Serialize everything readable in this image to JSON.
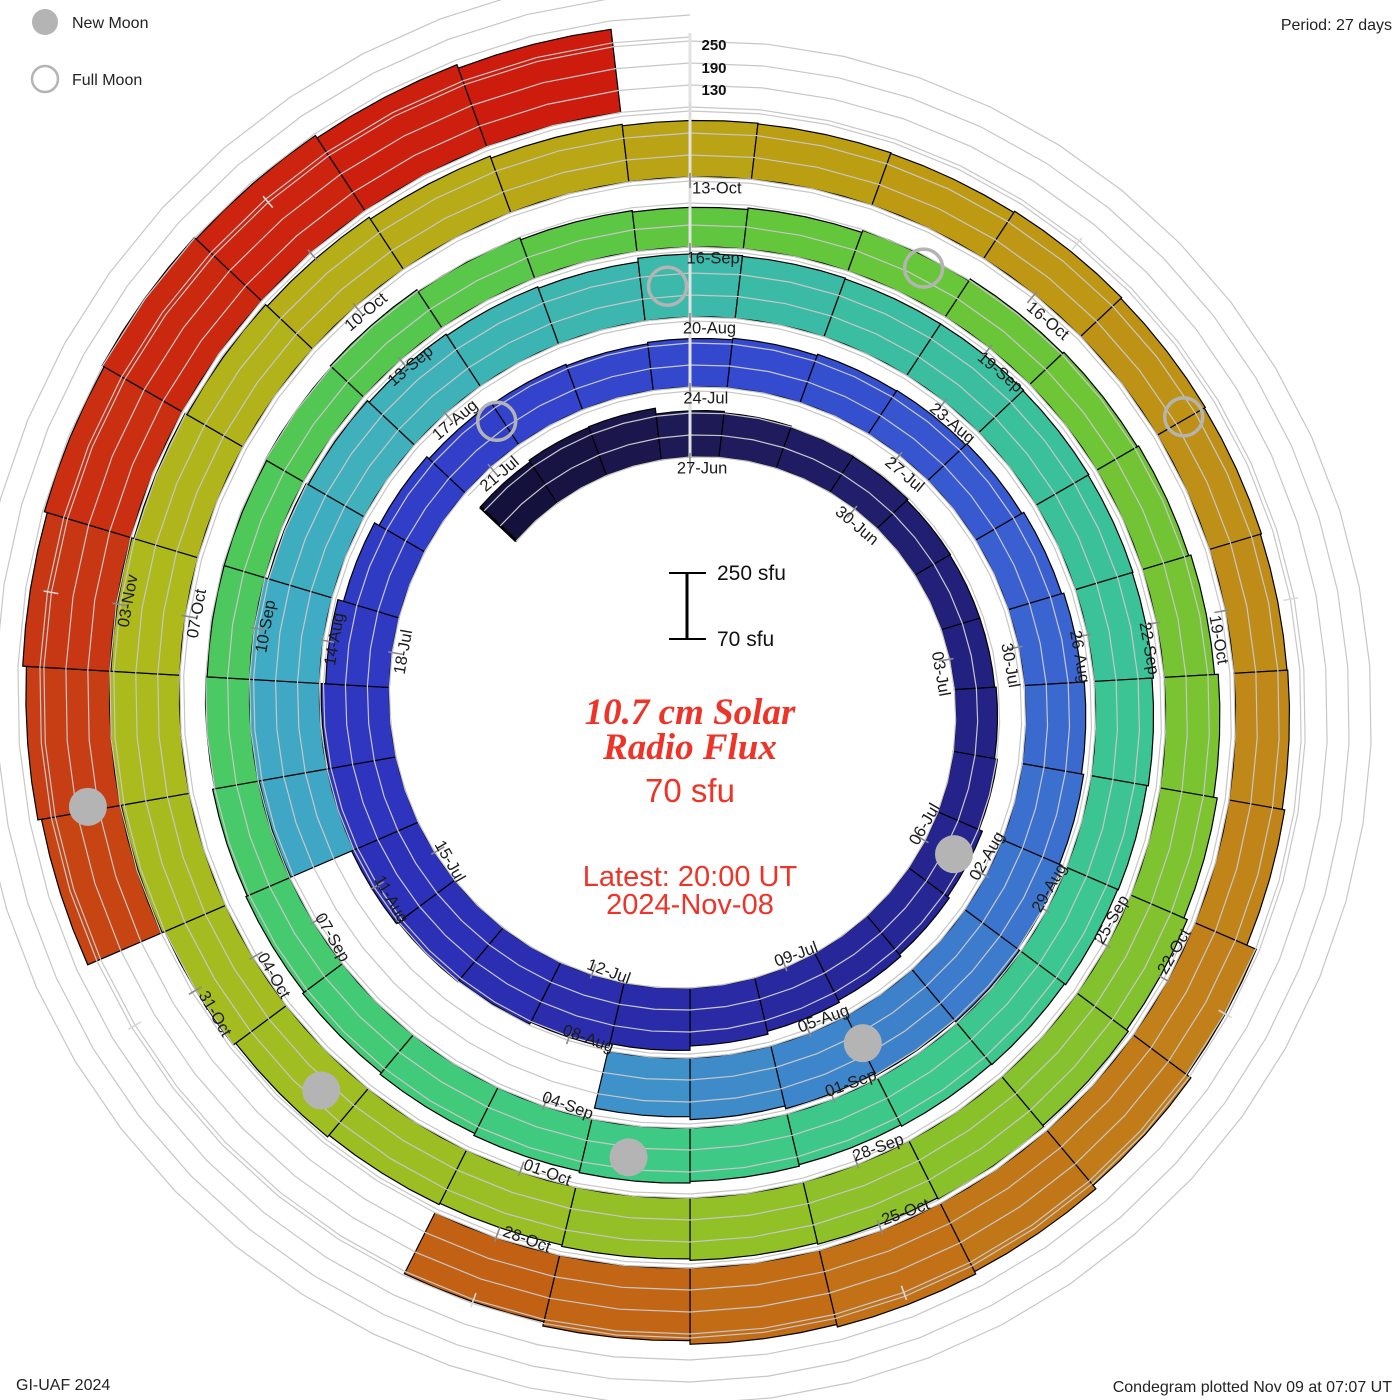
{
  "legend": {
    "new_moon": "New Moon",
    "full_moon": "Full Moon"
  },
  "period_note": "Period: 27 days",
  "credit_left": "GI-UAF 2024",
  "credit_right": "Condegram plotted Nov 09 at 07:07 UT",
  "scale_bar": {
    "top_label": "250 sfu",
    "bottom_label": "70 sfu"
  },
  "radial_axis": {
    "labels": [
      "250",
      "190",
      "130"
    ]
  },
  "center": {
    "title1": "10.7 cm Solar",
    "title2": "Radio Flux",
    "value": "70 sfu",
    "latest1": "Latest: 20:00 UT",
    "latest2": "2024-Nov-08"
  },
  "chart_data": {
    "type": "bar",
    "layout": "spiral polar condegram, clockwise from top, one solar rotation per turn",
    "title": "10.7 cm Solar Radio Flux",
    "period_days": 27,
    "label_step_days": 3,
    "flux_base": 70,
    "flux_scale_top": 250,
    "gridlines": [
      70,
      130,
      190,
      250
    ],
    "start_offset_days": -3,
    "ring_start_labels": [
      "27-Jun",
      "24-Jul",
      "20-Aug",
      "16-Sep",
      "13-Oct"
    ],
    "last_tick_label": "03-Nov",
    "units": "sfu",
    "days": [
      {
        "d": "24-Jun",
        "v": 205
      },
      {
        "d": "25-Jun",
        "v": 210
      },
      {
        "d": "26-Jun",
        "v": 212
      },
      {
        "d": "27-Jun",
        "v": 196
      },
      {
        "d": "28-Jun",
        "v": 192
      },
      {
        "d": "29-Jun",
        "v": 188
      },
      {
        "d": "30-Jun",
        "v": 186
      },
      {
        "d": "01-Jul",
        "v": 182
      },
      {
        "d": "02-Jul",
        "v": 180
      },
      {
        "d": "03-Jul",
        "v": 180
      },
      {
        "d": "04-Jul",
        "v": 184
      },
      {
        "d": "05-Jul",
        "v": 192
      },
      {
        "d": "06-Jul",
        "v": 202
      },
      {
        "d": "07-Jul",
        "v": 208
      },
      {
        "d": "08-Jul",
        "v": 214
      },
      {
        "d": "09-Jul",
        "v": 220
      },
      {
        "d": "10-Jul",
        "v": 228
      },
      {
        "d": "11-Jul",
        "v": 240
      },
      {
        "d": "12-Jul",
        "v": 252
      },
      {
        "d": "13-Jul",
        "v": 258
      },
      {
        "d": "14-Jul",
        "v": 262
      },
      {
        "d": "15-Jul",
        "v": 268
      },
      {
        "d": "16-Jul",
        "v": 264
      },
      {
        "d": "17-Jul",
        "v": 256
      },
      {
        "d": "18-Jul",
        "v": 244
      },
      {
        "d": "19-Jul",
        "v": 228
      },
      {
        "d": "20-Jul",
        "v": 214
      },
      {
        "d": "21-Jul",
        "v": 206
      },
      {
        "d": "22-Jul",
        "v": 202
      },
      {
        "d": "23-Jul",
        "v": 198
      },
      {
        "d": "24-Jul",
        "v": 202
      },
      {
        "d": "25-Jul",
        "v": 206
      },
      {
        "d": "26-Jul",
        "v": 210
      },
      {
        "d": "27-Jul",
        "v": 212
      },
      {
        "d": "28-Jul",
        "v": 216
      },
      {
        "d": "29-Jul",
        "v": 222
      },
      {
        "d": "30-Jul",
        "v": 228
      },
      {
        "d": "31-Jul",
        "v": 234
      },
      {
        "d": "01-Aug",
        "v": 240
      },
      {
        "d": "02-Aug",
        "v": 250
      },
      {
        "d": "03-Aug",
        "v": 256
      },
      {
        "d": "04-Aug",
        "v": 252
      },
      {
        "d": "05-Aug",
        "v": 246
      },
      {
        "d": "06-Aug",
        "v": 238
      },
      {
        "d": "07-Aug",
        "v": 230
      },
      {
        "d": "08-Aug",
        "v": null
      },
      {
        "d": "09-Aug",
        "v": null
      },
      {
        "d": "10-Aug",
        "v": null
      },
      {
        "d": "11-Aug",
        "v": null
      },
      {
        "d": "12-Aug",
        "v": 258
      },
      {
        "d": "13-Aug",
        "v": 266
      },
      {
        "d": "14-Aug",
        "v": 262
      },
      {
        "d": "15-Aug",
        "v": 252
      },
      {
        "d": "16-Aug",
        "v": 246
      },
      {
        "d": "17-Aug",
        "v": 240
      },
      {
        "d": "18-Aug",
        "v": 236
      },
      {
        "d": "19-Aug",
        "v": 232
      },
      {
        "d": "20-Aug",
        "v": 242
      },
      {
        "d": "21-Aug",
        "v": 240
      },
      {
        "d": "22-Aug",
        "v": 238
      },
      {
        "d": "23-Aug",
        "v": 238
      },
      {
        "d": "24-Aug",
        "v": 236
      },
      {
        "d": "25-Aug",
        "v": 234
      },
      {
        "d": "26-Aug",
        "v": 232
      },
      {
        "d": "27-Aug",
        "v": 228
      },
      {
        "d": "28-Aug",
        "v": 224
      },
      {
        "d": "29-Aug",
        "v": 222
      },
      {
        "d": "30-Aug",
        "v": 218
      },
      {
        "d": "31-Aug",
        "v": 216
      },
      {
        "d": "01-Sep",
        "v": 212
      },
      {
        "d": "02-Sep",
        "v": 216
      },
      {
        "d": "03-Sep",
        "v": 220
      },
      {
        "d": "04-Sep",
        "v": 216
      },
      {
        "d": "05-Sep",
        "v": 210
      },
      {
        "d": "06-Sep",
        "v": 205
      },
      {
        "d": "07-Sep",
        "v": 200
      },
      {
        "d": "08-Sep",
        "v": 196
      },
      {
        "d": "09-Sep",
        "v": 190
      },
      {
        "d": "10-Sep",
        "v": 186
      },
      {
        "d": "11-Sep",
        "v": 186
      },
      {
        "d": "12-Sep",
        "v": 190
      },
      {
        "d": "13-Sep",
        "v": 194
      },
      {
        "d": "14-Sep",
        "v": 188
      },
      {
        "d": "15-Sep",
        "v": 182
      },
      {
        "d": "16-Sep",
        "v": 178
      },
      {
        "d": "17-Sep",
        "v": 182
      },
      {
        "d": "18-Sep",
        "v": 188
      },
      {
        "d": "19-Sep",
        "v": 194
      },
      {
        "d": "20-Sep",
        "v": 198
      },
      {
        "d": "21-Sep",
        "v": 202
      },
      {
        "d": "22-Sep",
        "v": 208
      },
      {
        "d": "23-Sep",
        "v": 218
      },
      {
        "d": "24-Sep",
        "v": 228
      },
      {
        "d": "25-Sep",
        "v": 238
      },
      {
        "d": "26-Sep",
        "v": 244
      },
      {
        "d": "27-Sep",
        "v": 248
      },
      {
        "d": "28-Sep",
        "v": 244
      },
      {
        "d": "29-Sep",
        "v": 240
      },
      {
        "d": "30-Sep",
        "v": 236
      },
      {
        "d": "01-Oct",
        "v": 232
      },
      {
        "d": "02-Oct",
        "v": 236
      },
      {
        "d": "03-Oct",
        "v": 242
      },
      {
        "d": "04-Oct",
        "v": 250
      },
      {
        "d": "05-Oct",
        "v": 258
      },
      {
        "d": "06-Oct",
        "v": 262
      },
      {
        "d": "07-Oct",
        "v": 258
      },
      {
        "d": "08-Oct",
        "v": 252
      },
      {
        "d": "09-Oct",
        "v": 246
      },
      {
        "d": "10-Oct",
        "v": 240
      },
      {
        "d": "11-Oct",
        "v": 234
      },
      {
        "d": "12-Oct",
        "v": 228
      },
      {
        "d": "13-Oct",
        "v": 224
      },
      {
        "d": "14-Oct",
        "v": 222
      },
      {
        "d": "15-Oct",
        "v": 220
      },
      {
        "d": "16-Oct",
        "v": 224
      },
      {
        "d": "17-Oct",
        "v": 221
      },
      {
        "d": "18-Oct",
        "v": 218
      },
      {
        "d": "19-Oct",
        "v": 215
      },
      {
        "d": "20-Oct",
        "v": 217
      },
      {
        "d": "21-Oct",
        "v": 224
      },
      {
        "d": "22-Oct",
        "v": 252
      },
      {
        "d": "23-Oct",
        "v": 266
      },
      {
        "d": "24-Oct",
        "v": 278
      },
      {
        "d": "25-Oct",
        "v": 285
      },
      {
        "d": "26-Oct",
        "v": 278
      },
      {
        "d": "27-Oct",
        "v": 268
      },
      {
        "d": "28-Oct",
        "v": 256
      },
      {
        "d": "29-Oct",
        "v": null
      },
      {
        "d": "30-Oct",
        "v": null
      },
      {
        "d": "31-Oct",
        "v": null
      },
      {
        "d": "01-Nov",
        "v": 288
      },
      {
        "d": "02-Nov",
        "v": 298
      },
      {
        "d": "03-Nov",
        "v": 308
      },
      {
        "d": "04-Nov",
        "v": 316
      },
      {
        "d": "05-Nov",
        "v": 322
      },
      {
        "d": "06-Nov",
        "v": 316
      },
      {
        "d": "07-Nov",
        "v": 308
      },
      {
        "d": "08-Nov",
        "v": 298
      }
    ],
    "moons": [
      {
        "type": "new",
        "near": "06-Jul",
        "t": 8.96
      },
      {
        "type": "full",
        "near": "21-Jul",
        "t": 24.43
      },
      {
        "type": "new",
        "near": "04-Aug",
        "t": 38.47
      },
      {
        "type": "full",
        "near": "19-Aug",
        "t": 53.77
      },
      {
        "type": "new",
        "near": "03-Sep",
        "t": 68.08
      },
      {
        "type": "full",
        "near": "17-Sep",
        "t": 83.11
      },
      {
        "type": "new",
        "near": "02-Oct",
        "t": 97.78
      },
      {
        "type": "full",
        "near": "17-Oct",
        "t": 112.48
      },
      {
        "type": "new",
        "near": "01-Nov",
        "t": 127.53
      }
    ],
    "colormap": [
      [
        -3.5,
        "#120f38"
      ],
      [
        0,
        "#1e1a55"
      ],
      [
        6,
        "#232180"
      ],
      [
        12,
        "#28289f"
      ],
      [
        18,
        "#2d31ba"
      ],
      [
        24,
        "#3240c9"
      ],
      [
        28,
        "#344bcf"
      ],
      [
        33,
        "#3a64d0"
      ],
      [
        38,
        "#3e81cb"
      ],
      [
        44,
        "#40a0c8"
      ],
      [
        48,
        "#40abc4"
      ],
      [
        52,
        "#3db4b4"
      ],
      [
        56,
        "#3abda1"
      ],
      [
        62,
        "#3cc593"
      ],
      [
        68,
        "#3eca85"
      ],
      [
        72,
        "#45ca70"
      ],
      [
        77,
        "#52c754"
      ],
      [
        82,
        "#63c63b"
      ],
      [
        87,
        "#76c433"
      ],
      [
        92,
        "#89c12b"
      ],
      [
        97,
        "#9dbe22"
      ],
      [
        102,
        "#aeb91c"
      ],
      [
        107,
        "#b9a716"
      ],
      [
        110,
        "#bd9a12"
      ],
      [
        114,
        "#bf8c18"
      ],
      [
        118,
        "#c17c19"
      ],
      [
        122,
        "#c26615"
      ],
      [
        125,
        "#c35411"
      ],
      [
        128,
        "#c73e14"
      ],
      [
        131,
        "#cb2810"
      ],
      [
        134.5,
        "#cd190d"
      ]
    ],
    "colors": {
      "grid": "#c7c7c7",
      "bar_outline": "#000000",
      "tick": "#8a8a8a",
      "outer_tick": "#d9d9d9",
      "axis_line": "#e2e2e2",
      "moon": "#b4b4b4",
      "label_text": "#1b1b1b",
      "title_red": "#ee3429"
    }
  }
}
